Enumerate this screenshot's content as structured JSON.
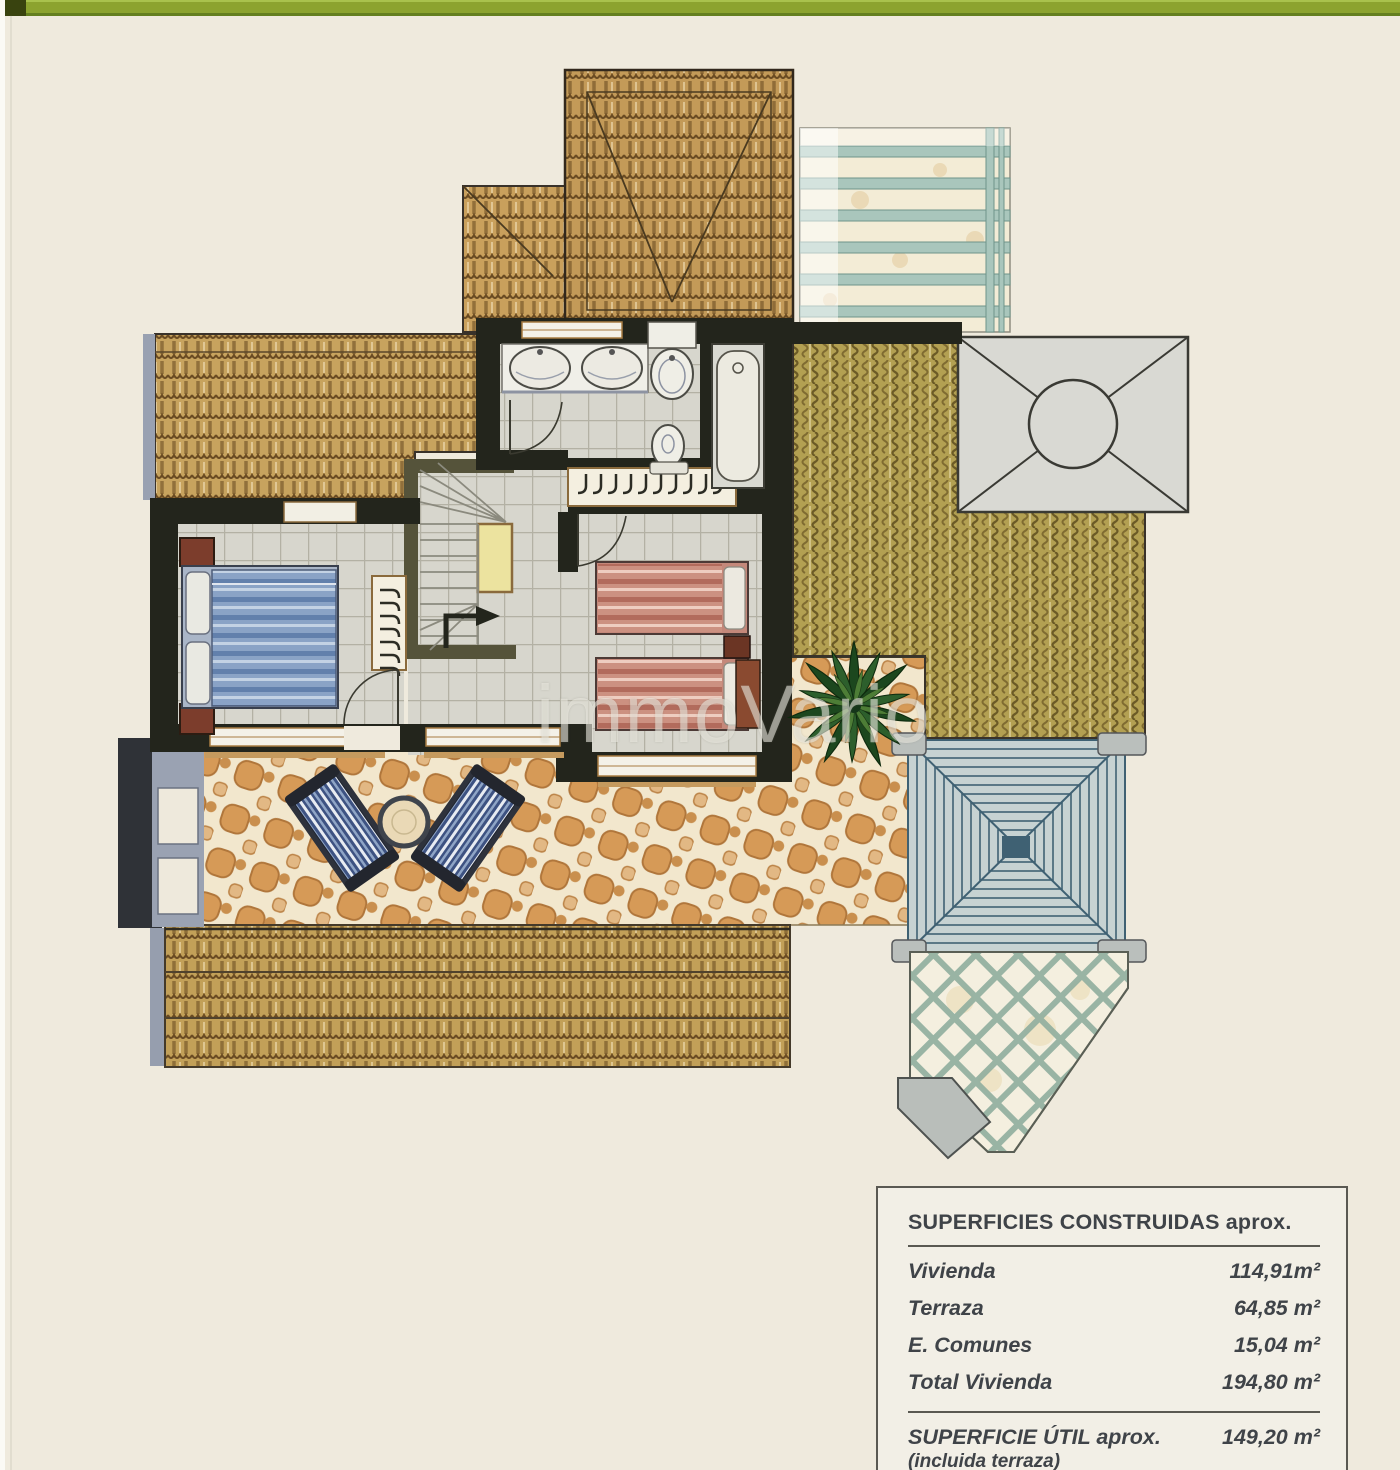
{
  "watermark": {
    "text": "immoVario"
  },
  "colors": {
    "accent_green": "#8CA32F",
    "paper": "#EFEADD",
    "table_border": "#5A5952"
  },
  "areas_table": {
    "title": "SUPERFICIES CONSTRUIDAS aprox.",
    "rows": [
      {
        "label": "Vivienda",
        "value": "114,91m²"
      },
      {
        "label": "Terraza",
        "value": "64,85 m²"
      },
      {
        "label": "E. Comunes",
        "value": "15,04 m²"
      },
      {
        "label": "Total Vivienda",
        "value": "194,80 m²"
      }
    ],
    "footer": {
      "label": "SUPERFICIE ÚTIL aprox.",
      "note": "(incluida terraza)",
      "value": "149,20 m²"
    }
  }
}
